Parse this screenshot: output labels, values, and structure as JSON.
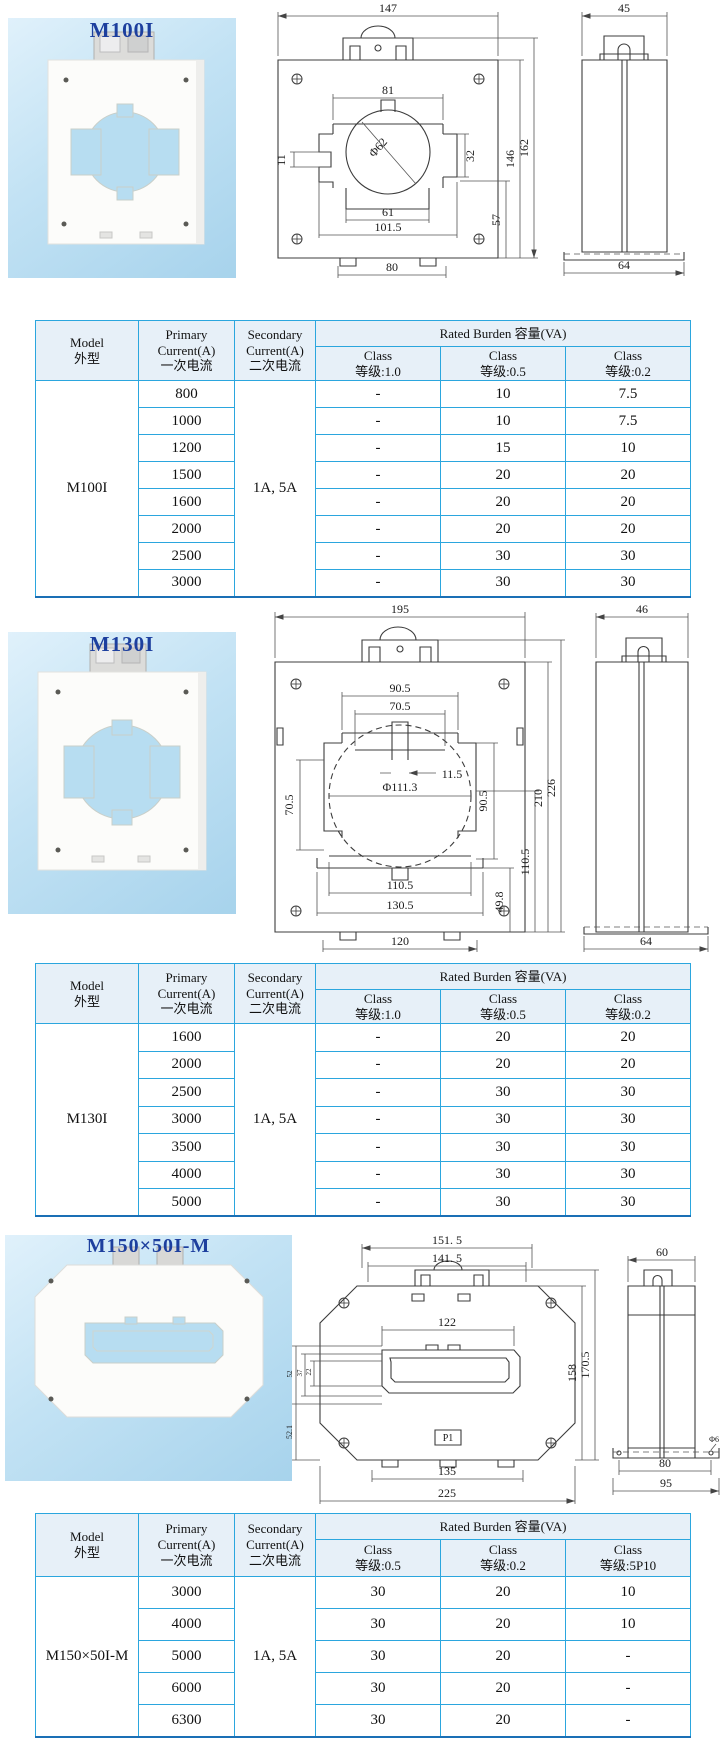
{
  "colors": {
    "table_border": "#2ba6de",
    "table_border_bottom": "#1a6fb5",
    "table_header_bg": "#e7f0f8",
    "model_label_blue": "#1d3f9e",
    "photo_panel_blue": "#bfe1f3",
    "drawing_line": "#3c3c3c"
  },
  "sections": [
    {
      "label": "M100I",
      "front": {
        "width": "147",
        "hole_top": "81",
        "diameter": "Φ62",
        "step_left": "11",
        "step_right": "32",
        "hole_bottom": "61",
        "hole_outer": "101.5",
        "body_height": "146",
        "total_height": "162",
        "lower_height": "57",
        "feet_span": "80"
      },
      "side": {
        "width": "45",
        "base_width": "64"
      }
    },
    {
      "label": "M130I",
      "front": {
        "width": "195",
        "top_outer": "90.5",
        "top_inner": "70.5",
        "tab": "11.5",
        "diameter": "Φ111.3",
        "left_height": "70.5",
        "right_height": "90.5",
        "right_1": "110.5",
        "right_2": "210",
        "right_3": "226",
        "lower_right": "49.8",
        "bottom_inner": "110.5",
        "bottom_outer": "130.5",
        "feet_span": "120"
      },
      "side": {
        "width": "46",
        "base_width": "64"
      }
    },
    {
      "label": "M150×50I-M",
      "front": {
        "width_outer": "151. 5",
        "width_inner": "141. 5",
        "hole_width": "122",
        "left_1": "52",
        "left_2": "37",
        "left_3": "22",
        "left_4": "52.1",
        "right_1": "158",
        "right_2": "170.5",
        "terminal": "P1",
        "feet_span": "135",
        "total_width": "225"
      },
      "side": {
        "width": "60",
        "hole_dia": "Φ6",
        "base_1": "80",
        "base_2": "95"
      }
    }
  ],
  "tables": [
    {
      "headers": {
        "model": "Model\n外型",
        "primary": "Primary\nCurrent(A)\n一次电流",
        "secondary": "Secondary\nCurrent(A)\n二次电流",
        "burden": "Rated Burden 容量(VA)",
        "classes": [
          "Class\n等级:1.0",
          "Class\n等级:0.5",
          "Class\n等级:0.2"
        ]
      },
      "model": "M100I",
      "secondary": "1A, 5A",
      "rows": [
        [
          "800",
          "-",
          "10",
          "7.5"
        ],
        [
          "1000",
          "-",
          "10",
          "7.5"
        ],
        [
          "1200",
          "-",
          "15",
          "10"
        ],
        [
          "1500",
          "-",
          "20",
          "20"
        ],
        [
          "1600",
          "-",
          "20",
          "20"
        ],
        [
          "2000",
          "-",
          "20",
          "20"
        ],
        [
          "2500",
          "-",
          "30",
          "30"
        ],
        [
          "3000",
          "-",
          "30",
          "30"
        ]
      ]
    },
    {
      "headers": {
        "model": "Model\n外型",
        "primary": "Primary\nCurrent(A)\n一次电流",
        "secondary": "Secondary\nCurrent(A)\n二次电流",
        "burden": "Rated Burden 容量(VA)",
        "classes": [
          "Class\n等级:1.0",
          "Class\n等级:0.5",
          "Class\n等级:0.2"
        ]
      },
      "model": "M130I",
      "secondary": "1A, 5A",
      "rows": [
        [
          "1600",
          "-",
          "20",
          "20"
        ],
        [
          "2000",
          "-",
          "20",
          "20"
        ],
        [
          "2500",
          "-",
          "30",
          "30"
        ],
        [
          "3000",
          "-",
          "30",
          "30"
        ],
        [
          "3500",
          "-",
          "30",
          "30"
        ],
        [
          "4000",
          "-",
          "30",
          "30"
        ],
        [
          "5000",
          "-",
          "30",
          "30"
        ]
      ]
    },
    {
      "headers": {
        "model": "Model\n外型",
        "primary": "Primary\nCurrent(A)\n一次电流",
        "secondary": "Secondary\nCurrent(A)\n二次电流",
        "burden": "Rated Burden 容量(VA)",
        "classes": [
          "Class\n等级:0.5",
          "Class\n等级:0.2",
          "Class\n等级:5P10"
        ]
      },
      "model": "M150×50I-M",
      "secondary": "1A, 5A",
      "rows": [
        [
          "3000",
          "30",
          "20",
          "10"
        ],
        [
          "4000",
          "30",
          "20",
          "10"
        ],
        [
          "5000",
          "30",
          "20",
          "-"
        ],
        [
          "6000",
          "30",
          "20",
          "-"
        ],
        [
          "6300",
          "30",
          "20",
          "-"
        ]
      ]
    }
  ]
}
